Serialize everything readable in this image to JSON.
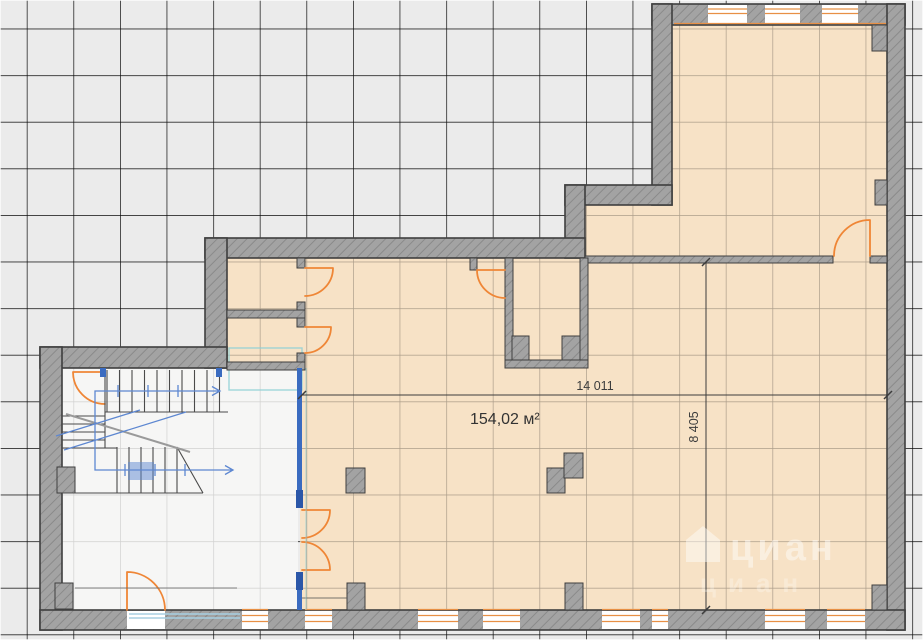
{
  "plan": {
    "area_label": "154,02 м²",
    "dimensions": {
      "horizontal": "14 011",
      "vertical": "8 405"
    },
    "watermark": {
      "brand": "циан",
      "brand_secondary": "циан"
    },
    "colors": {
      "background": "#ebebeb",
      "grid_line": "#ffffff",
      "floor": "#f7e2c6",
      "floor_grid": "#c99f6b",
      "stairwell_floor": "#f6f6f5",
      "wall_fill": "#a3a3a3",
      "wall_hatch": "#8a8a8a",
      "wall_edge": "#3f3f3f",
      "door": "#ef8636",
      "window_frame": "#e89045",
      "partition_blue": "#3a6bc0",
      "stair_line": "#5d87d1",
      "glazing_teal": "#8fd0d6",
      "dimension": "#3c3c3c",
      "threshold_blue": "#a8cfe2"
    }
  }
}
